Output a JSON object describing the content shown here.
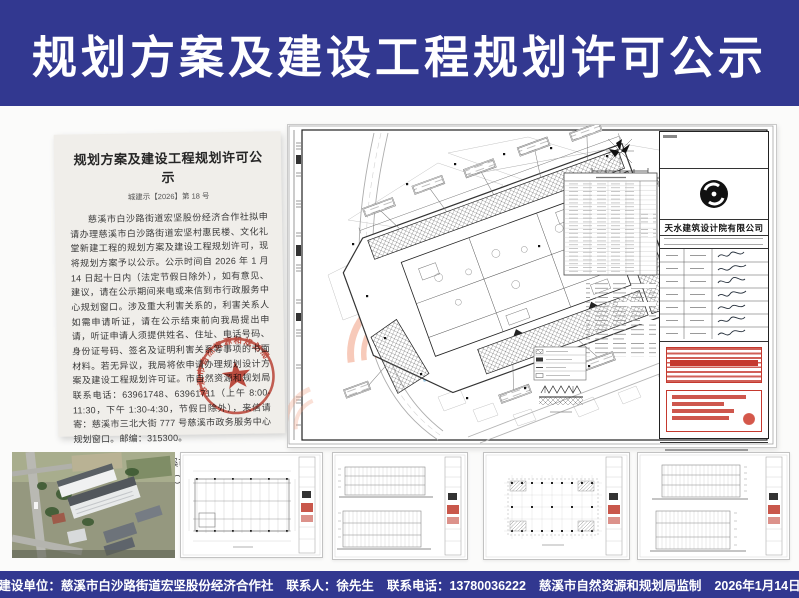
{
  "header": {
    "title": "规划方案及建设工程规划许可公示"
  },
  "notice": {
    "title": "规划方案及建设工程规划许可公示",
    "doc_no": "城建示【2026】第 18 号",
    "body": "慈溪市白沙路街道宏坚股份经济合作社拟申请办理慈溪市白沙路街道宏坚村惠民楼、文化礼堂新建工程的规划方案及建设工程规划许可，现将规划方案予以公示。公示时间自 2026 年 1 月 14 日起十日内（法定节假日除外），如有意见、建议，请在公示期间来电或来信到市行政服务中心规划窗口。涉及重大利害关系的，利害关系人如需申请听证，请在公示结束前向我局提出申请，听证申请人须提供姓名、住址、电话号码、身份证号码、签名及证明利害关系等事项的书面材料。若无异议，我局将依申请办理规划设计方案及建设工程规划许可证。市自然资源和规划局联系电话：63961748、63961711（上午 8:00-11:30，下午 1:30-4:30，节假日除外），来信请寄：慈溪市三北大街 777 号慈溪市政务服务中心规划窗口。邮编：315300。",
    "signature": "慈溪市自然资源和规划局",
    "date": "二〇二六年一月十四日",
    "seal_text": "慈溪市自然资源和规划局"
  },
  "sheet": {
    "company": "天水建筑设计院有限公司"
  },
  "footer": {
    "items": [
      "建设单位：慈溪市白沙路街道宏坚股份经济合作社",
      "联系人：徐先生",
      "联系电话：13780036222",
      "慈溪市自然资源和规划局监制",
      "2026年1月14日"
    ]
  },
  "colors": {
    "banner_blue": "#323890",
    "seal_red": "#c0392b",
    "watermark_blue": "#4d9fd6",
    "watermark_orange": "#f2a083"
  }
}
